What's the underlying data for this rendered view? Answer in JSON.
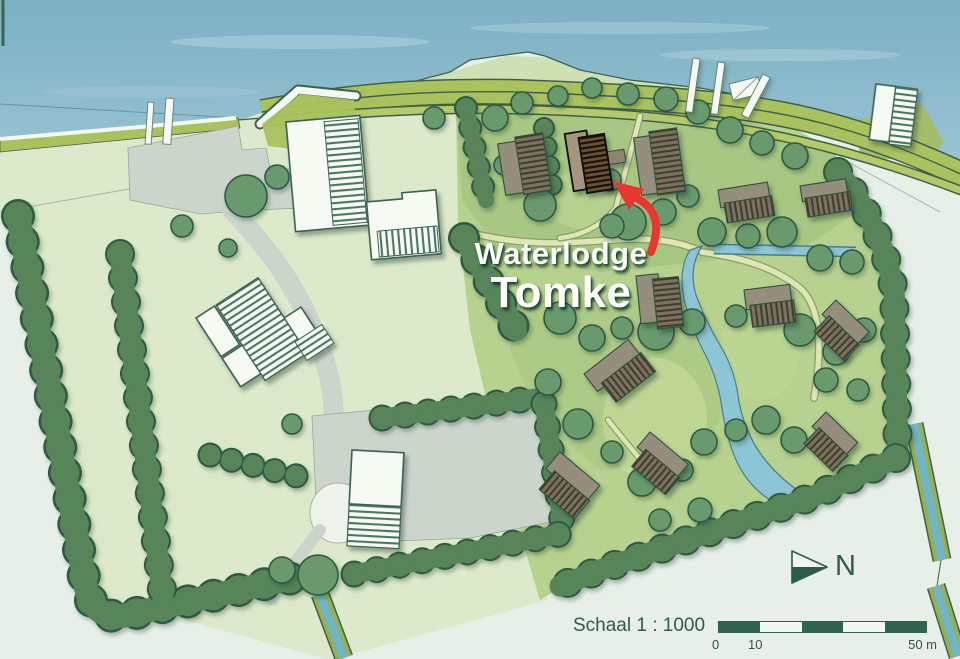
{
  "title": {
    "line1": "Waterlodge",
    "line2": "Tomke"
  },
  "compass": {
    "label": "N"
  },
  "scale_bar": {
    "label": "Schaal 1 : 1000",
    "ticks": [
      "0",
      "10",
      "50 m"
    ],
    "segments": 5
  },
  "highlight": {
    "name": "Waterlodge Tomke",
    "arrow_color": "#e8372e"
  },
  "palette": {
    "water": "#87b7ca",
    "water_light": "#aacfdc",
    "land_pale": "#e7efe8",
    "field": "#dde9cb",
    "headland": "#cfe0b4",
    "park": "#b7d28e",
    "park_dark": "#9cbd78",
    "dike": "#a9c25e",
    "outline": "#3c6352",
    "tree": "#699a6e",
    "tree_dark": "#2e5a44",
    "hedge": "#578459",
    "paved": "#ccd5cb",
    "building_white": "#f7faf3",
    "lodge_body": "#968e7c",
    "lodge_roof": "#7a7260",
    "tomke_roof": "#6b5130",
    "pond": "#8cc5d5",
    "ditch_blue": "#6fb6c9",
    "text_green": "#2e5b4d",
    "scale_dark": "#2f6550",
    "title_text": "#fcfdf9",
    "arrow_red": "#e8372e"
  }
}
